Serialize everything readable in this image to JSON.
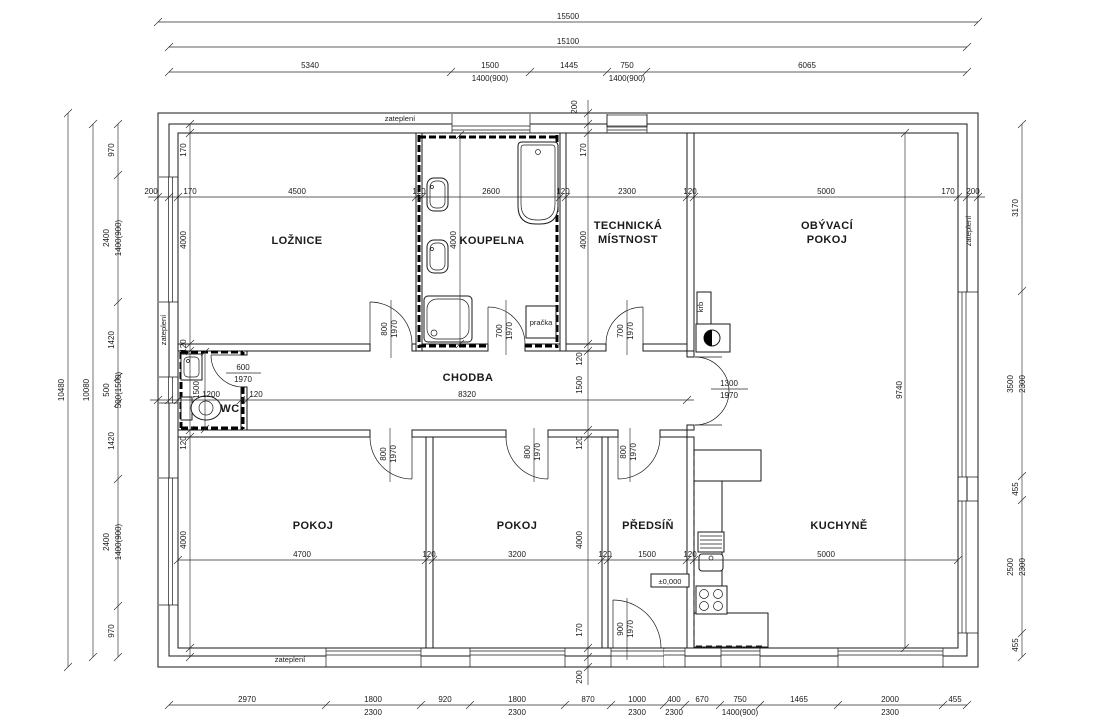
{
  "drawing_labels": {
    "rooms": [
      {
        "t": "LOŽNICE",
        "x": 297,
        "y": 244
      },
      {
        "t": "KOUPELNA",
        "x": 492,
        "y": 244
      },
      {
        "t": "TECHNICKÁ",
        "x": 628,
        "y": 229
      },
      {
        "t": "MÍSTNOST",
        "x": 628,
        "y": 243
      },
      {
        "t": "OBÝVACÍ",
        "x": 827,
        "y": 229
      },
      {
        "t": "POKOJ",
        "x": 827,
        "y": 243
      },
      {
        "t": "CHODBA",
        "x": 468,
        "y": 381
      },
      {
        "t": "WC",
        "x": 230,
        "y": 412
      },
      {
        "t": "POKOJ",
        "x": 313,
        "y": 529
      },
      {
        "t": "POKOJ",
        "x": 517,
        "y": 529
      },
      {
        "t": "PŘEDSÍŇ",
        "x": 648,
        "y": 529
      },
      {
        "t": "KUCHYNĚ",
        "x": 839,
        "y": 529
      }
    ],
    "dims": [
      {
        "t": "15500",
        "x": 568,
        "y": 19
      },
      {
        "t": "15100",
        "x": 568,
        "y": 44
      },
      {
        "t": "5340",
        "x": 310,
        "y": 68
      },
      {
        "t": "1500",
        "x": 490,
        "y": 68
      },
      {
        "t": "1445",
        "x": 569,
        "y": 68
      },
      {
        "t": "750",
        "x": 627,
        "y": 68
      },
      {
        "t": "6065",
        "x": 807,
        "y": 68
      },
      {
        "t": "1400(900)",
        "x": 490,
        "y": 81
      },
      {
        "t": "1400(900)",
        "x": 627,
        "y": 81
      },
      {
        "t": "200",
        "x": 151,
        "y": 194
      },
      {
        "t": "170",
        "x": 190,
        "y": 194
      },
      {
        "t": "4500",
        "x": 297,
        "y": 194
      },
      {
        "t": "120",
        "x": 419,
        "y": 194
      },
      {
        "t": "2600",
        "x": 491,
        "y": 194
      },
      {
        "t": "120",
        "x": 563,
        "y": 194
      },
      {
        "t": "2300",
        "x": 627,
        "y": 194
      },
      {
        "t": "120",
        "x": 690,
        "y": 194
      },
      {
        "t": "5000",
        "x": 826,
        "y": 194
      },
      {
        "t": "170",
        "x": 948,
        "y": 194
      },
      {
        "t": "200",
        "x": 973,
        "y": 194
      },
      {
        "t": "10480",
        "x": 64,
        "y": 390,
        "r": -90
      },
      {
        "t": "10080",
        "x": 89,
        "y": 390,
        "r": -90
      },
      {
        "t": "970",
        "x": 114,
        "y": 150,
        "r": -90
      },
      {
        "t": "2400",
        "x": 109,
        "y": 238,
        "r": -90
      },
      {
        "t": "1400(900)",
        "x": 121,
        "y": 238,
        "r": -90
      },
      {
        "t": "1420",
        "x": 114,
        "y": 340,
        "r": -90
      },
      {
        "t": "500",
        "x": 109,
        "y": 390,
        "r": -90
      },
      {
        "t": "500(1500)",
        "x": 121,
        "y": 390,
        "r": -90
      },
      {
        "t": "1420",
        "x": 114,
        "y": 441,
        "r": -90
      },
      {
        "t": "2400",
        "x": 109,
        "y": 542,
        "r": -90
      },
      {
        "t": "1400(900)",
        "x": 121,
        "y": 542,
        "r": -90
      },
      {
        "t": "970",
        "x": 114,
        "y": 631,
        "r": -90
      },
      {
        "t": "3170",
        "x": 1018,
        "y": 208,
        "r": -90
      },
      {
        "t": "3500",
        "x": 1013,
        "y": 384,
        "r": -90
      },
      {
        "t": "2300",
        "x": 1025,
        "y": 384,
        "r": -90
      },
      {
        "t": "455",
        "x": 1018,
        "y": 489,
        "r": -90
      },
      {
        "t": "2500",
        "x": 1013,
        "y": 567,
        "r": -90
      },
      {
        "t": "2300",
        "x": 1025,
        "y": 567,
        "r": -90
      },
      {
        "t": "455",
        "x": 1018,
        "y": 645,
        "r": -90
      },
      {
        "t": "2970",
        "x": 247,
        "y": 702
      },
      {
        "t": "1800",
        "x": 373,
        "y": 702
      },
      {
        "t": "920",
        "x": 445,
        "y": 702
      },
      {
        "t": "1800",
        "x": 517,
        "y": 702
      },
      {
        "t": "870",
        "x": 588,
        "y": 702
      },
      {
        "t": "1000",
        "x": 637,
        "y": 702
      },
      {
        "t": "400",
        "x": 674,
        "y": 702
      },
      {
        "t": "670",
        "x": 702,
        "y": 702
      },
      {
        "t": "750",
        "x": 740,
        "y": 702
      },
      {
        "t": "1465",
        "x": 799,
        "y": 702
      },
      {
        "t": "2000",
        "x": 890,
        "y": 702
      },
      {
        "t": "455",
        "x": 955,
        "y": 702
      },
      {
        "t": "2300",
        "x": 373,
        "y": 715
      },
      {
        "t": "2300",
        "x": 517,
        "y": 715
      },
      {
        "t": "2300",
        "x": 637,
        "y": 715
      },
      {
        "t": "2300",
        "x": 674,
        "y": 715
      },
      {
        "t": "1400(900)",
        "x": 740,
        "y": 715
      },
      {
        "t": "2300",
        "x": 890,
        "y": 715
      },
      {
        "t": "200",
        "x": 577,
        "y": 107,
        "r": -90
      },
      {
        "t": "170",
        "x": 586,
        "y": 150,
        "r": -90
      },
      {
        "t": "170",
        "x": 186,
        "y": 150,
        "r": -90
      },
      {
        "t": "4000",
        "x": 186,
        "y": 240,
        "r": -90
      },
      {
        "t": "4000",
        "x": 456,
        "y": 240,
        "r": -90
      },
      {
        "t": "4000",
        "x": 586,
        "y": 240,
        "r": -90
      },
      {
        "t": "120",
        "x": 186,
        "y": 346,
        "r": -90
      },
      {
        "t": "120",
        "x": 582,
        "y": 359,
        "r": -90
      },
      {
        "t": "1500",
        "x": 582,
        "y": 385,
        "r": -90
      },
      {
        "t": "120",
        "x": 582,
        "y": 443,
        "r": -90
      },
      {
        "t": "1500",
        "x": 199,
        "y": 390,
        "r": -90
      },
      {
        "t": "120",
        "x": 186,
        "y": 443,
        "r": -90
      },
      {
        "t": "4000",
        "x": 186,
        "y": 540,
        "r": -90
      },
      {
        "t": "4000",
        "x": 582,
        "y": 540,
        "r": -90
      },
      {
        "t": "170",
        "x": 582,
        "y": 630,
        "r": -90
      },
      {
        "t": "200",
        "x": 582,
        "y": 677,
        "r": -90
      },
      {
        "t": "9740",
        "x": 902,
        "y": 390,
        "r": -90
      },
      {
        "t": "1200",
        "x": 211,
        "y": 397
      },
      {
        "t": "120",
        "x": 256,
        "y": 397
      },
      {
        "t": "8320",
        "x": 467,
        "y": 397
      },
      {
        "t": "4700",
        "x": 302,
        "y": 557
      },
      {
        "t": "120",
        "x": 429,
        "y": 557
      },
      {
        "t": "3200",
        "x": 517,
        "y": 557
      },
      {
        "t": "120",
        "x": 605,
        "y": 557
      },
      {
        "t": "1500",
        "x": 647,
        "y": 557
      },
      {
        "t": "120",
        "x": 690,
        "y": 557
      },
      {
        "t": "5000",
        "x": 826,
        "y": 557
      },
      {
        "t": "800",
        "x": 387,
        "y": 329,
        "r": -90
      },
      {
        "t": "1970",
        "x": 397,
        "y": 329,
        "r": -90
      },
      {
        "t": "700",
        "x": 502,
        "y": 331,
        "r": -90
      },
      {
        "t": "1970",
        "x": 512,
        "y": 331,
        "r": -90
      },
      {
        "t": "700",
        "x": 623,
        "y": 331,
        "r": -90
      },
      {
        "t": "1970",
        "x": 633,
        "y": 331,
        "r": -90
      },
      {
        "t": "600",
        "x": 243,
        "y": 370
      },
      {
        "t": "1970",
        "x": 243,
        "y": 382
      },
      {
        "t": "800",
        "x": 386,
        "y": 454,
        "r": -90
      },
      {
        "t": "1970",
        "x": 396,
        "y": 454,
        "r": -90
      },
      {
        "t": "800",
        "x": 530,
        "y": 452,
        "r": -90
      },
      {
        "t": "1970",
        "x": 540,
        "y": 452,
        "r": -90
      },
      {
        "t": "800",
        "x": 626,
        "y": 452,
        "r": -90
      },
      {
        "t": "1970",
        "x": 636,
        "y": 452,
        "r": -90
      },
      {
        "t": "900",
        "x": 623,
        "y": 629,
        "r": -90
      },
      {
        "t": "1970",
        "x": 633,
        "y": 629,
        "r": -90
      },
      {
        "t": "1300",
        "x": 729,
        "y": 386
      },
      {
        "t": "1970",
        "x": 729,
        "y": 398
      }
    ],
    "annotations": [
      {
        "t": "zateplení",
        "x": 400,
        "y": 121
      },
      {
        "t": "zateplení",
        "x": 166,
        "y": 330,
        "r": -90
      },
      {
        "t": "zateplení",
        "x": 971,
        "y": 231,
        "r": -90
      },
      {
        "t": "zateplení",
        "x": 290,
        "y": 662
      },
      {
        "t": "pračka",
        "x": 541,
        "y": 325
      },
      {
        "t": "krb",
        "x": 703,
        "y": 307,
        "r": -90
      },
      {
        "t": "±0,000",
        "x": 670,
        "y": 584
      }
    ]
  }
}
